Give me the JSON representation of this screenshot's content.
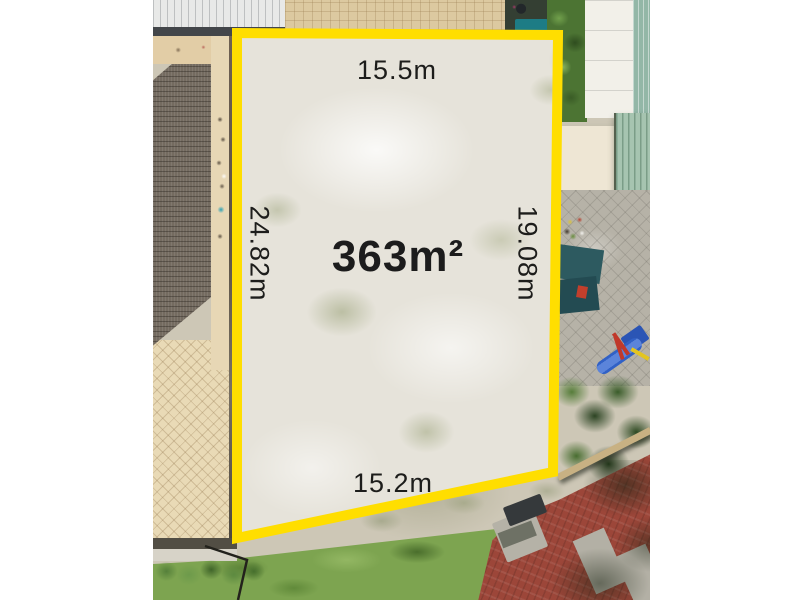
{
  "photo": {
    "description": "aerial-drone-view-of-vacant-land-lot-for-sale",
    "labels": {
      "area": "363m²",
      "top": "15.5m",
      "left": "24.82m",
      "right": "19.08m",
      "bottom": "15.2m"
    },
    "colors": {
      "boundary": "#FFDE00",
      "label_text": "#1D1D1B",
      "frame": "#FFFFFF"
    }
  }
}
